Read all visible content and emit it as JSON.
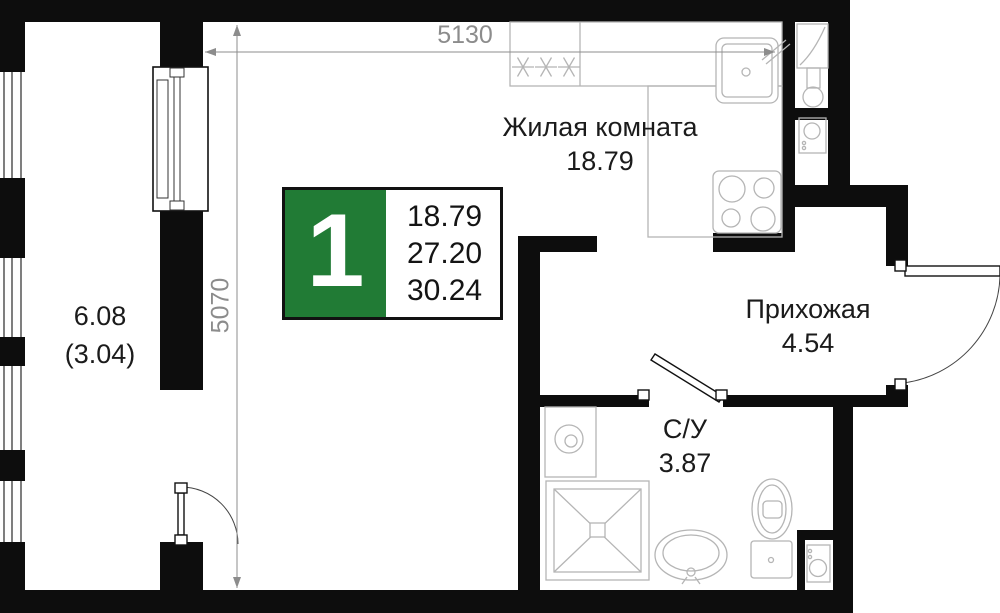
{
  "plan": {
    "badge": {
      "rooms_count": "1",
      "areas": [
        "18.79",
        "27.20",
        "30.24"
      ]
    },
    "rooms": {
      "living": {
        "name": "Жилая комната",
        "area": "18.79"
      },
      "hall": {
        "name": "Прихожая",
        "area": "4.54"
      },
      "bath": {
        "name": "С/У",
        "area": "3.87"
      },
      "balcony": {
        "area": "6.08",
        "area_coef": "(3.04)"
      }
    },
    "dimensions": {
      "width_mm": "5130",
      "height_mm": "5070"
    },
    "colors": {
      "badge_green": "#217B35",
      "wall_color": "#0d0d0d",
      "dim_color": "#8c8c8c",
      "fixture_color": "#b5b5b5"
    }
  }
}
